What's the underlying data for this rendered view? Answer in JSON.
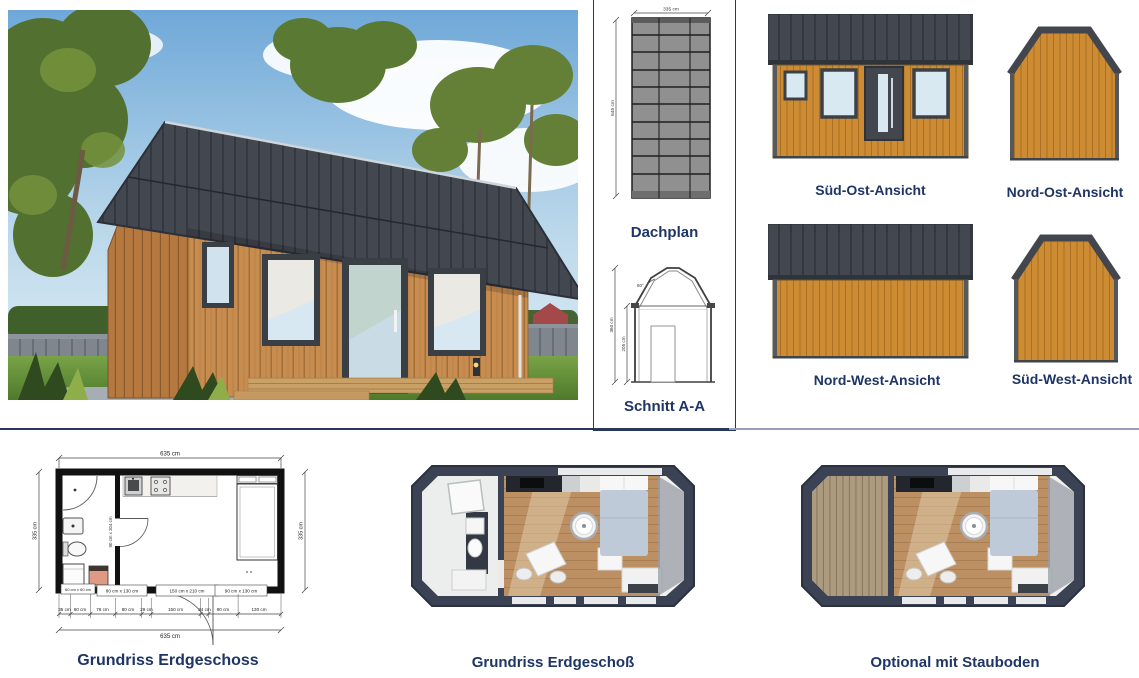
{
  "sheet": {
    "roof_plan": {
      "title": "Dachplan",
      "dim_width": "335 cm",
      "dim_length": "645 cm"
    },
    "section": {
      "title": "Schnitt A-A",
      "dim_total_height": "360 cm",
      "dim_wall_height": "205 cm",
      "dim_angle": "60°"
    },
    "elevations": [
      {
        "label": "Süd-Ost-Ansicht"
      },
      {
        "label": "Nord-Ost-Ansicht"
      },
      {
        "label": "Nord-West-Ansicht"
      },
      {
        "label": "Süd-West-Ansicht"
      }
    ],
    "floor_plan": {
      "caption": "Grundriss Erdgeschoss",
      "dim_top": "635 cm",
      "dim_bottom": "635 cm",
      "dim_left": "335 cm",
      "dim_right": "335 cm",
      "chain": [
        "35 cm",
        "60 cm",
        "76 cm",
        "80 cm",
        "29 cm",
        "150 cm",
        "24 cm",
        "90 cm",
        "130 cm"
      ],
      "labels": {
        "window_left": "80 cm x 130 cm",
        "door": "150 cm x 210 cm",
        "window_right": "90 cm x 130 cm",
        "interior_door": "90 cm x 204 cm",
        "appliance": "60 cm x 60 cm"
      }
    },
    "render_plan": {
      "caption": "Grundriss Erdgeschoß"
    },
    "optional_plan": {
      "caption": "Optional mit Stauboden"
    },
    "colors": {
      "accent": "#1e3565",
      "siding": "#cd8b33",
      "roof": "#43474f",
      "glass": "#d9e9f2",
      "render_wall": "#3a4254",
      "floor_wood": "#bd9063",
      "slats": "#b7a488"
    }
  }
}
